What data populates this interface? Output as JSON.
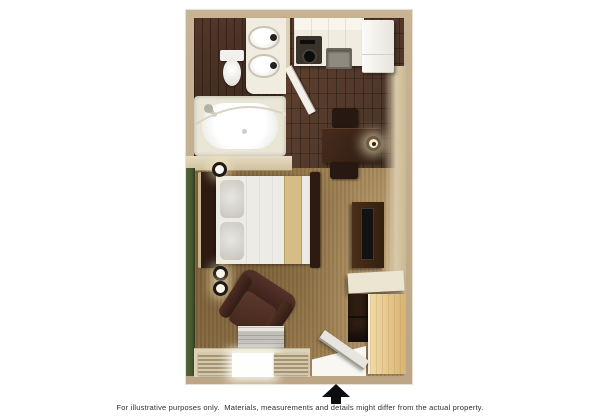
{
  "disclaimer": "For illustrative purposes only.  Materials, measurements and details might differ from the actual property.",
  "entrance": {
    "arrow_direction": "up",
    "arrow_color": "#0d0d0d"
  },
  "palette": {
    "wall": "#c8b494",
    "wall_shade": "#bca685",
    "trim": "#e9e1cb",
    "wood_a": "#3f2a1e",
    "wood_b": "#5a3a28",
    "carpet_a": "#9c7d4f",
    "carpet_b": "#82653c",
    "green": "#46542d",
    "counter": "#f0ecdf",
    "linen": "#edebe6",
    "runner": "#d6bd85",
    "closet": "#d9b372",
    "arrow": "#0d0d0d",
    "text": "#2f2f2f"
  },
  "fixtures": {
    "bathroom": [
      "toilet",
      "double-sink-vanity",
      "bathtub",
      "shower-curtain-rod",
      "showerhead",
      "bathroom-door"
    ],
    "kitchen": [
      "kitchen-counter",
      "stove",
      "kitchen-sink",
      "refrigerator"
    ],
    "living_area": [
      "bed",
      "headboard",
      "pillows",
      "bed-runner",
      "wall-sconces",
      "desk",
      "desk-chairs",
      "desk-lamp",
      "tv-dresser",
      "tv",
      "counter-shelf",
      "storage-shelf",
      "closet",
      "armchair",
      "ac-unit",
      "window",
      "curtains",
      "entry-door"
    ]
  }
}
